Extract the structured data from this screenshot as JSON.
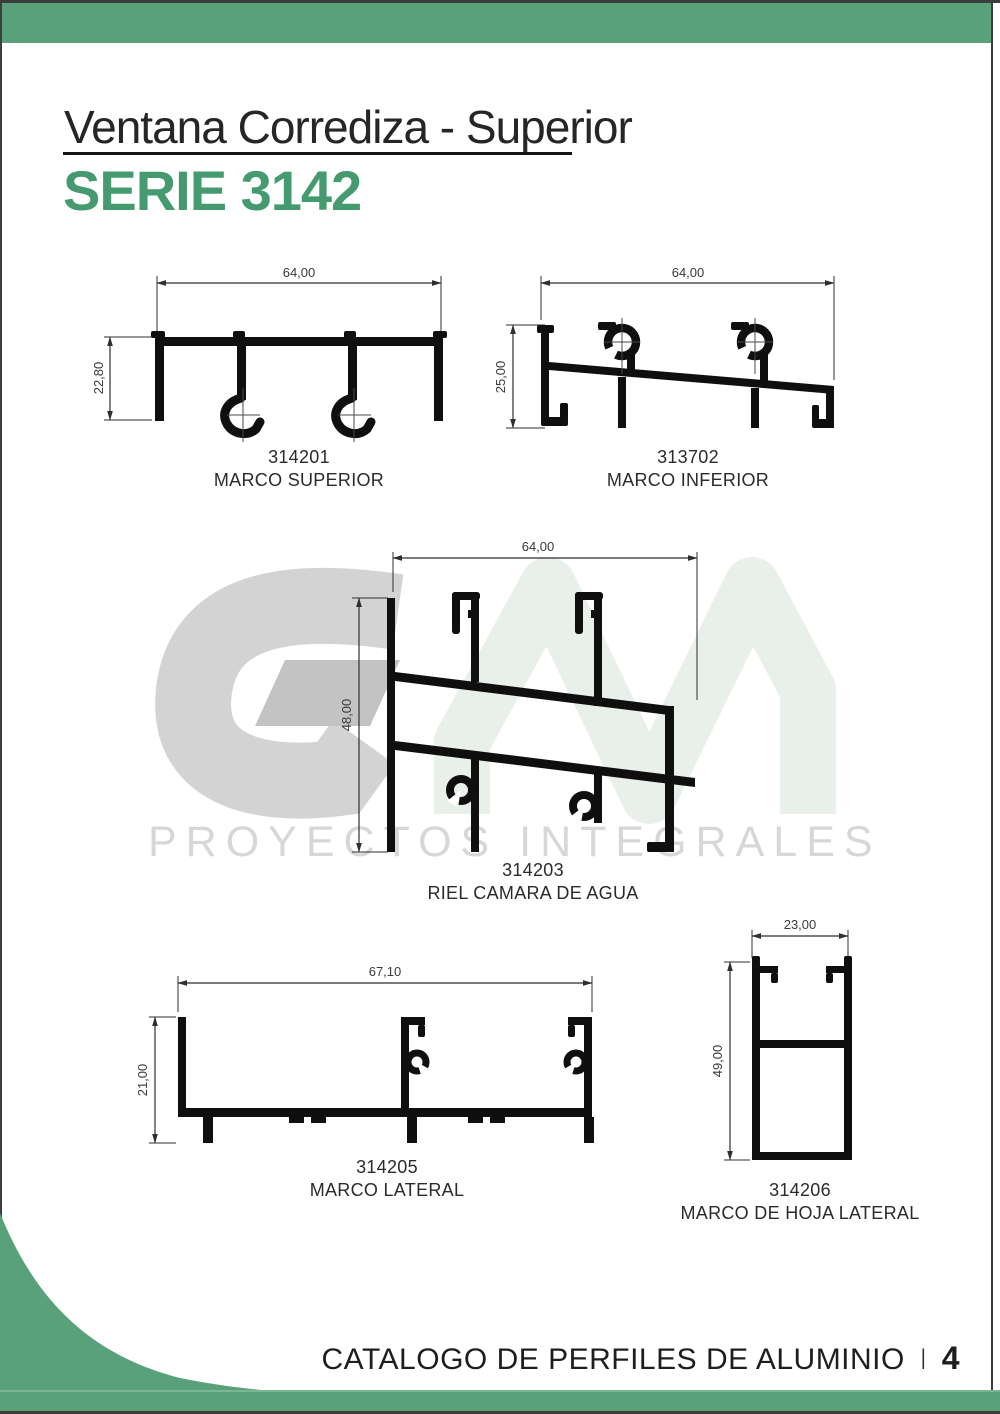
{
  "header": {
    "title": "Ventana Corrediza - Superior",
    "series": "SERIE 3142"
  },
  "watermark": {
    "brand": "GM",
    "tagline": "PROYECTOS INTEGRALES"
  },
  "profiles": [
    {
      "code": "314201",
      "name": "MARCO SUPERIOR",
      "width_dim": "64,00",
      "height_dim": "22,80"
    },
    {
      "code": "313702",
      "name": "MARCO INFERIOR",
      "width_dim": "64,00",
      "height_dim": "25,00"
    },
    {
      "code": "314203",
      "name": "RIEL CAMARA DE AGUA",
      "width_dim": "64,00",
      "height_dim": "48,00"
    },
    {
      "code": "314205",
      "name": "MARCO LATERAL",
      "width_dim": "67,10",
      "height_dim": "21,00"
    },
    {
      "code": "314206",
      "name": "MARCO DE HOJA LATERAL",
      "width_dim": "23,00",
      "height_dim": "49,00"
    }
  ],
  "footer": {
    "catalog": "CATALOGO DE PERFILES DE ALUMINIO",
    "separator": "I",
    "page": "4"
  },
  "colors": {
    "accent_green": "#58a17b",
    "series_green": "#459a6f",
    "drawing_ink": "#0f0f0f",
    "watermark_gray": "#d3d3d3",
    "watermark_light_green": "#e9efe9"
  }
}
